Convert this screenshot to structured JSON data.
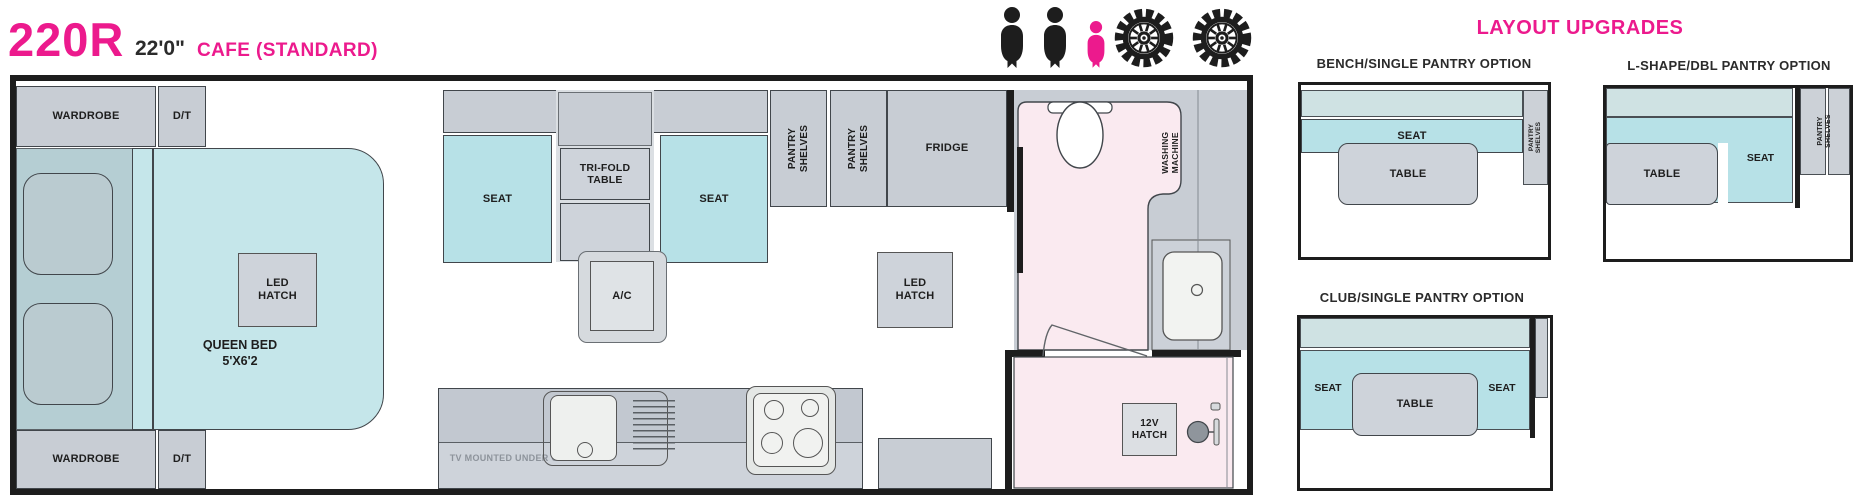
{
  "header": {
    "model": "220R",
    "length": "22'0\"",
    "variant": "CAFE (STANDARD)",
    "upgrades_title": "LAYOUT UPGRADES"
  },
  "icons": {
    "adult_icons": 2,
    "child_icons": 1,
    "wheel_icons": 2,
    "adult_color": "#1d1d1d",
    "child_color": "#ec1a8d"
  },
  "colors": {
    "brand_pink": "#ec1a8d",
    "cabinet_gray": "#c8cdd4",
    "seat_teal": "#b7e1e7",
    "bed_teal": "#c5e6ea",
    "bathroom_pink": "#faeaf0",
    "wall_black": "#1d1d1d"
  },
  "floorplan": {
    "wardrobe": "WARDROBE",
    "dt": "D/T",
    "queen_bed": "QUEEN BED",
    "queen_bed_size": "5'X6'2",
    "led_hatch": "LED HATCH",
    "seat": "SEAT",
    "trifold_table": "TRI-FOLD TABLE",
    "ac": "A/C",
    "pantry_shelves": "PANTRY SHELVES",
    "fridge": "FRIDGE",
    "washing_machine": "WASHING MACHINE",
    "twelve_v_hatch": "12V HATCH",
    "tv_note": "TV MOUNTED UNDER O/H"
  },
  "upgrades": [
    {
      "title": "BENCH/SINGLE PANTRY OPTION",
      "seat": "SEAT",
      "table": "TABLE",
      "pantry": "PANTRY SHELVES"
    },
    {
      "title": "L-SHAPE/DBL PANTRY OPTION",
      "seat": "SEAT",
      "table": "TABLE",
      "pantry": "PANTRY SHELVES"
    },
    {
      "title": "CLUB/SINGLE PANTRY OPTION",
      "seat_left": "SEAT",
      "seat_right": "SEAT",
      "table": "TABLE"
    }
  ]
}
